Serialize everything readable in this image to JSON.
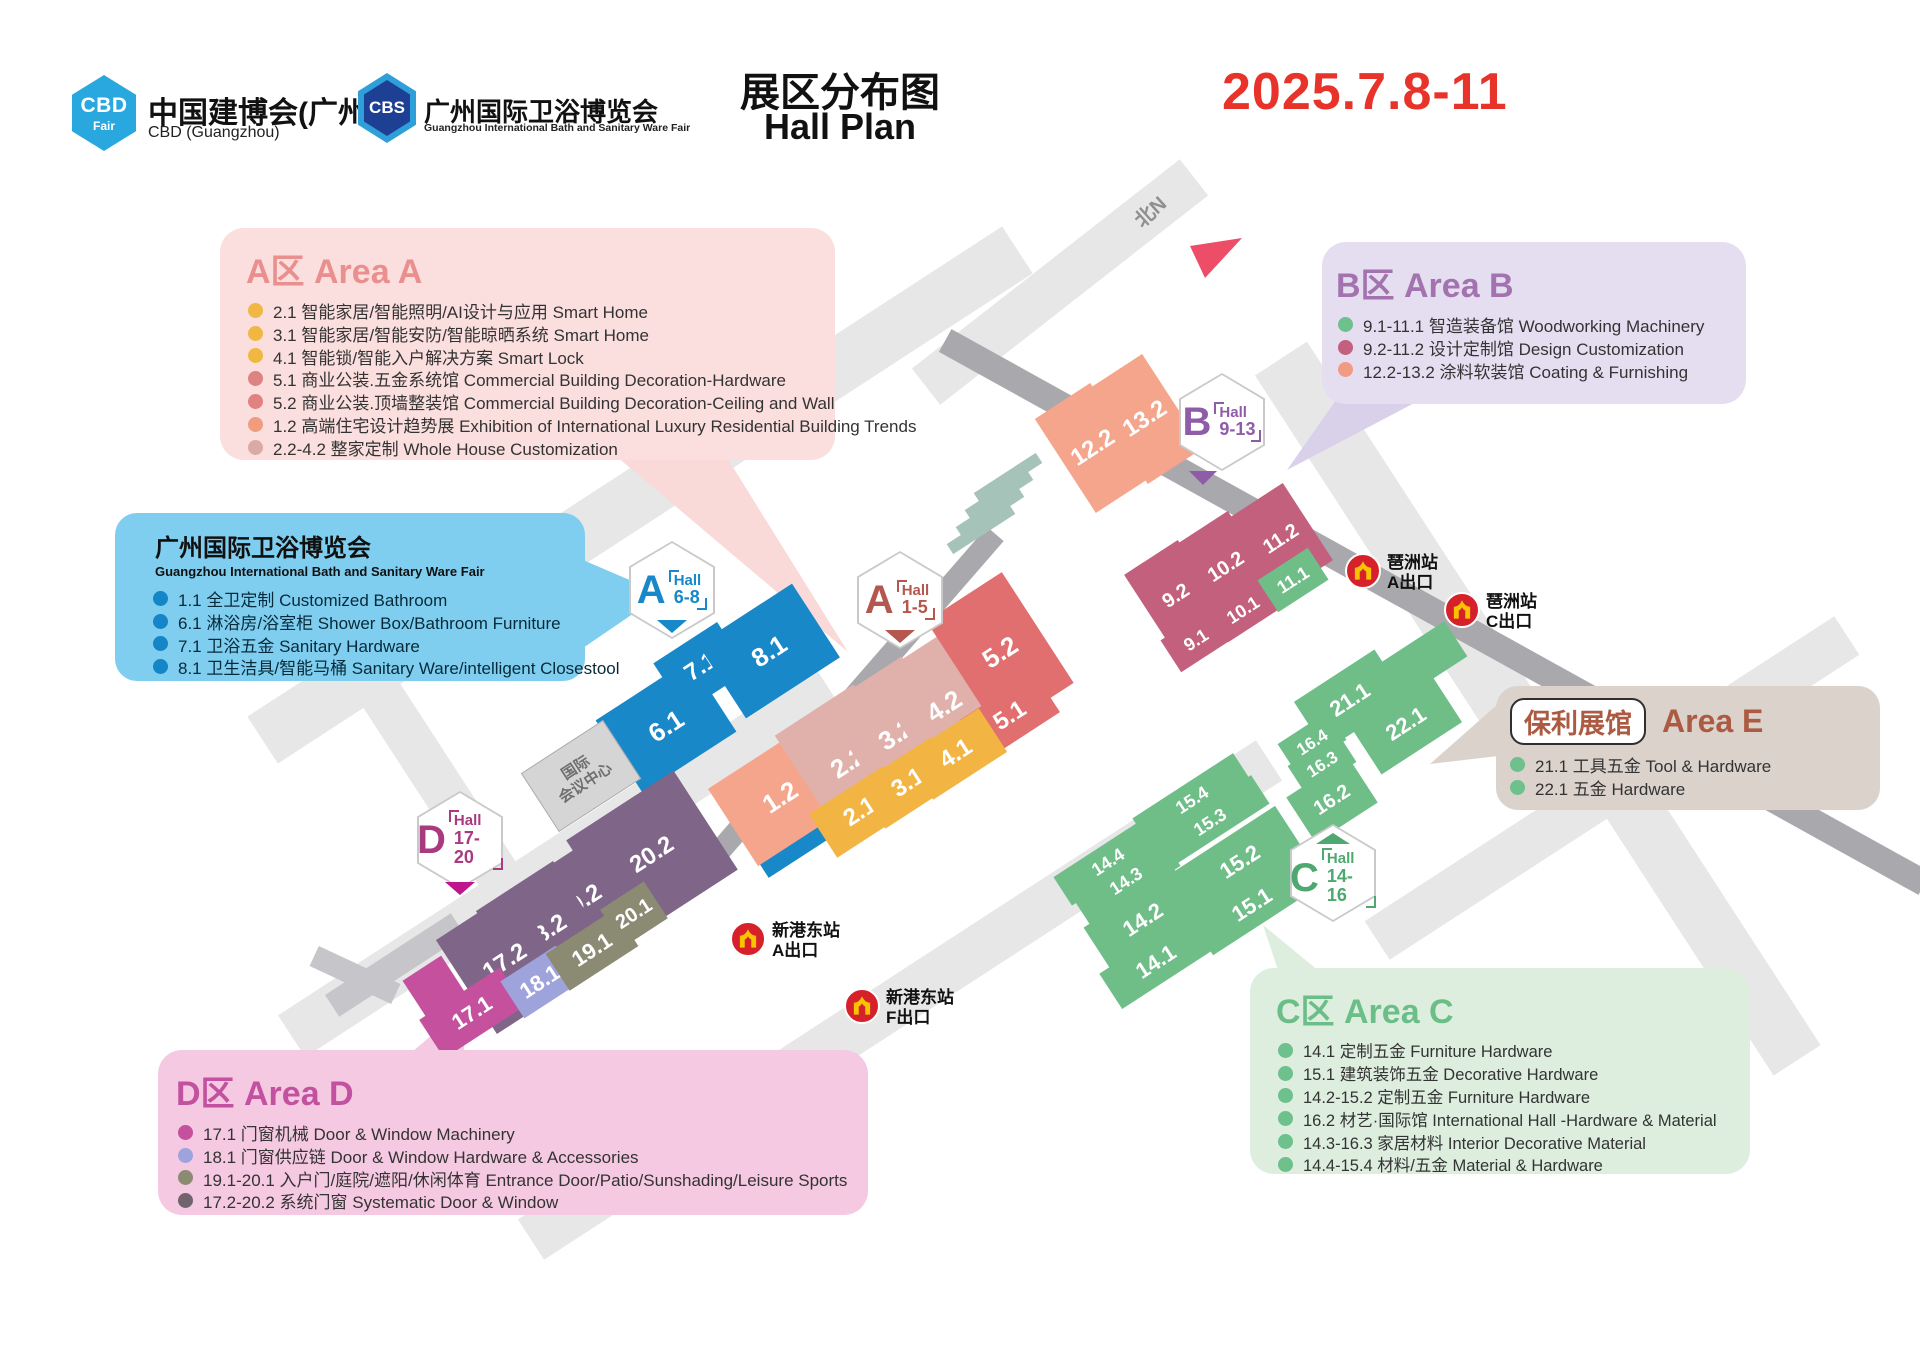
{
  "header": {
    "logo_cbd": {
      "abbr": "CBD",
      "sub": "Fair",
      "title": "中国建博会(广州)",
      "subtitle": "CBD (Guangzhou)"
    },
    "logo_cbs": {
      "abbr": "CBS",
      "title": "广州国际卫浴博览会",
      "subtitle": "Guangzhou International Bath and Sanitary Ware Fair"
    },
    "title_cn": "展区分布图",
    "title_en": "Hall Plan",
    "date": "2025.7.8-11"
  },
  "legend_a": {
    "title": "A区 Area A",
    "items": [
      {
        "dot": "#F0B843",
        "text": "2.1 智能家居/智能照明/AI设计与应用 Smart Home"
      },
      {
        "dot": "#F0B843",
        "text": "3.1 智能家居/智能安防/智能晾晒系统 Smart Home"
      },
      {
        "dot": "#F0B843",
        "text": "4.1 智能锁/智能入户解决方案 Smart Lock"
      },
      {
        "dot": "#DF8282",
        "text": "5.1 商业公装.五金系统馆 Commercial Building Decoration-Hardware"
      },
      {
        "dot": "#DF8282",
        "text": "5.2 商业公装.顶墙整装馆 Commercial Building Decoration-Ceiling and Wall"
      },
      {
        "dot": "#F29B7E",
        "text": "1.2 高端住宅设计趋势展 Exhibition of International Luxury Residential Building Trends"
      },
      {
        "dot": "#D9ABA6",
        "text": "2.2-4.2 整家定制 Whole House Customization"
      }
    ]
  },
  "legend_bath": {
    "title": "广州国际卫浴博览会",
    "subtitle": "Guangzhou International Bath and Sanitary Ware Fair",
    "items": [
      {
        "dot": "#1486C7",
        "text": "1.1 全卫定制 Customized Bathroom"
      },
      {
        "dot": "#1486C7",
        "text": "6.1 淋浴房/浴室柜 Shower Box/Bathroom Furniture"
      },
      {
        "dot": "#1486C7",
        "text": "7.1 卫浴五金 Sanitary Hardware"
      },
      {
        "dot": "#1486C7",
        "text": "8.1 卫生洁具/智能马桶 Sanitary Ware/intelligent Closestool"
      }
    ]
  },
  "legend_b": {
    "title": "B区 Area B",
    "items": [
      {
        "dot": "#6EC08C",
        "text": "9.1-11.1 智造装备馆 Woodworking Machinery"
      },
      {
        "dot": "#C2607E",
        "text": "9.2-11.2 设计定制馆 Design Customization"
      },
      {
        "dot": "#F09B84",
        "text": "12.2-13.2 涂料软装馆 Coating & Furnishing"
      }
    ]
  },
  "legend_e": {
    "chip": "保利展馆",
    "title": "Area E",
    "items": [
      {
        "dot": "#6EC08C",
        "text": "21.1 工具五金 Tool & Hardware"
      },
      {
        "dot": "#6EC08C",
        "text": "22.1 五金 Hardware"
      }
    ]
  },
  "legend_c": {
    "title": "C区 Area C",
    "items": [
      {
        "dot": "#6EC08C",
        "text": "14.1 定制五金 Furniture Hardware"
      },
      {
        "dot": "#6EC08C",
        "text": "15.1 建筑装饰五金 Decorative Hardware"
      },
      {
        "dot": "#6EC08C",
        "text": "14.2-15.2 定制五金 Furniture Hardware"
      },
      {
        "dot": "#6EC08C",
        "text": "16.2 材艺·国际馆 International Hall -Hardware & Material"
      },
      {
        "dot": "#6EC08C",
        "text": "14.3-16.3 家居材料 Interior Decorative Material"
      },
      {
        "dot": "#6EC08C",
        "text": "14.4-15.4 材料/五金 Material & Hardware"
      }
    ]
  },
  "legend_d": {
    "title": "D区 Area D",
    "items": [
      {
        "dot": "#C4509E",
        "text": "17.1 门窗机械 Door & Window Machinery"
      },
      {
        "dot": "#9FA3DC",
        "text": "18.1 门窗供应链 Door & Window Hardware & Accessories"
      },
      {
        "dot": "#8B8B74",
        "text": "19.1-20.1 入户门/庭院/遮阳/休闲体育 Entrance Door/Patio/Sunshading/Leisure Sports"
      },
      {
        "dot": "#71646E",
        "text": "17.2-20.2 系统门窗 Systematic Door & Window"
      }
    ]
  },
  "map": {
    "badges": {
      "a68": {
        "letter": "A",
        "word": "Hall",
        "range": "6-8"
      },
      "a15": {
        "letter": "A",
        "word": "Hall",
        "range": "1-5"
      },
      "b913": {
        "letter": "B",
        "word": "Hall",
        "range": "9-13"
      },
      "c1416": {
        "letter": "C",
        "word": "Hall",
        "range": "14-16"
      },
      "d1720": {
        "letter": "D",
        "word": "Hall",
        "range": "17-20"
      }
    },
    "halls": {
      "h1_1": "1.1",
      "h1_2": "1.2",
      "h2_1": "2.1",
      "h2_2": "2.2",
      "h3_1": "3.1",
      "h3_2": "3.2",
      "h4_1": "4.1",
      "h4_2": "4.2",
      "h5_1": "5.1",
      "h5_2": "5.2",
      "h6_1": "6.1",
      "h7_1": "7.1",
      "h8_1": "8.1",
      "h9_1": "9.1",
      "h9_2": "9.2",
      "h10_1": "10.1",
      "h10_2": "10.2",
      "h11_1": "11.1",
      "h11_2": "11.2",
      "h12_2": "12.2",
      "h13_2": "13.2",
      "h14_1": "14.1",
      "h14_2": "14.2",
      "h14_3": "14.3",
      "h14_4": "14.4",
      "h15_1": "15.1",
      "h15_2": "15.2",
      "h15_3": "15.3",
      "h15_4": "15.4",
      "h16_2": "16.2",
      "h16_3": "16.3",
      "h16_4": "16.4",
      "h17_1": "17.1",
      "h17_2": "17.2",
      "h18_1": "18.1",
      "h18_2": "18.2",
      "h19_1": "19.1",
      "h19_2": "19.2",
      "h20_1": "20.1",
      "h20_2": "20.2",
      "h21_1": "21.1",
      "h22_1": "22.1"
    },
    "stations": {
      "pazhou_a": {
        "name": "琶洲站",
        "exit": "A",
        "exit_word": "出口"
      },
      "pazhou_c": {
        "name": "琶洲站",
        "exit": "C",
        "exit_word": "出口"
      },
      "xingang_a": {
        "name": "新港东站",
        "exit": "A",
        "exit_word": "出口"
      },
      "xingang_f": {
        "name": "新港东站",
        "exit": "F",
        "exit_word": "出口"
      }
    },
    "north_label": "北N",
    "conference_line1": "国际",
    "conference_line2": "会议中心"
  },
  "colors": {
    "date_red": "#E8332A",
    "cbd_blue": "#29A8E0",
    "cbs_navy": "#1D3F94",
    "map_blue": "#1888C9",
    "map_salmon": "#F5A58B",
    "map_dusty_pink": "#E0B1AA",
    "map_red": "#E26F6F",
    "map_yellow": "#F2B544",
    "map_rose": "#C2607E",
    "map_green": "#6FBE88",
    "map_purple": "#7F6688",
    "map_magenta": "#C4509E",
    "map_periwinkle": "#9FA3DC",
    "map_olive": "#8B8B74",
    "map_teal": "#A5C3B9",
    "road_light": "#E7E7E8",
    "road_dark": "#A8A8AD",
    "metro_red": "#D6212B",
    "metro_yellow": "#F8C300"
  }
}
